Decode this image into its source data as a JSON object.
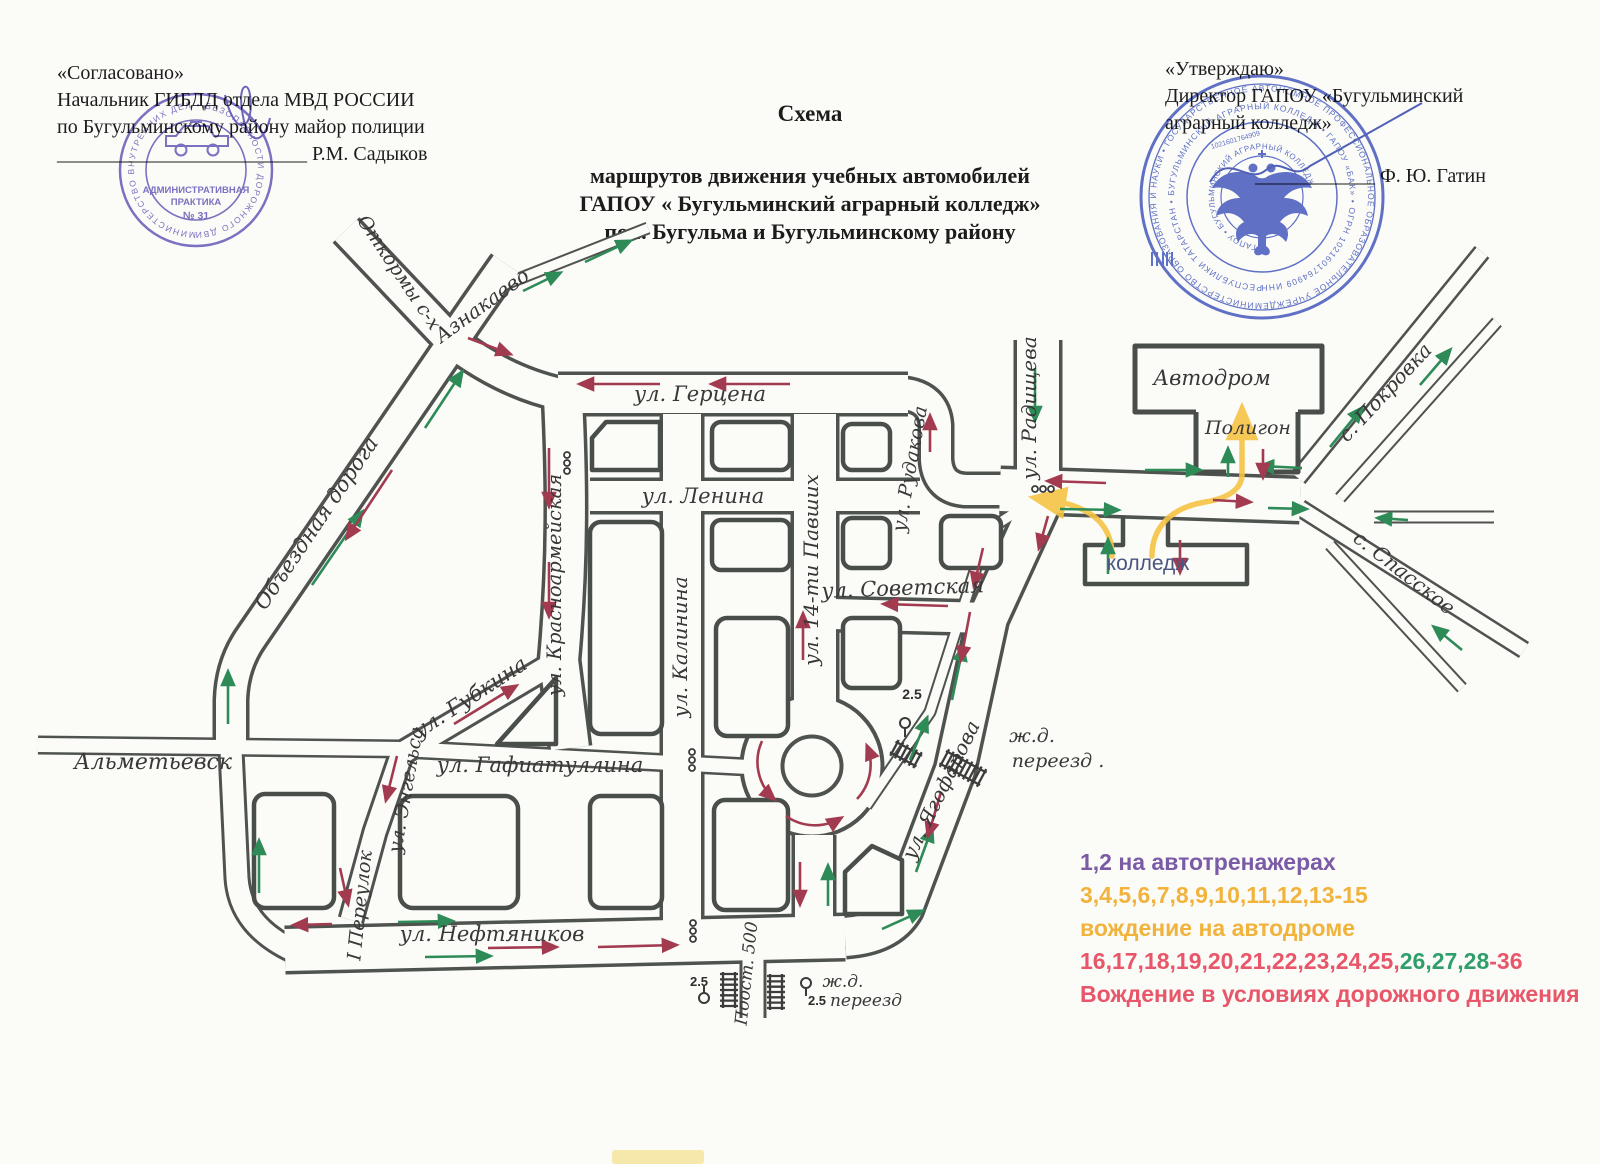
{
  "header": {
    "approval_left": {
      "quoted": "«Согласовано»",
      "line2": "Начальник ГИБДД отдела МВД РОССИИ",
      "line3": "по Бугульминскому району майор полиции",
      "line4": "_________________________ Р.М. Садыков"
    },
    "title": {
      "t1": "Схема",
      "t2": "маршрутов движения учебных автомобилей",
      "t3": "ГАПОУ  « Бугульминский аграрный колледж»",
      "t4": "по г. Бугульма и Бугульминскому району"
    },
    "approval_right": {
      "quoted": "«Утверждаю»",
      "line2": "Директор ГАПОУ   «Бугульминский",
      "line3": "аграрный колледж»",
      "line4": "____________ Ф. Ю. Гатин"
    }
  },
  "stamps": {
    "left": {
      "ring": "МИНИСТЕРСТВО ВНУТРЕННИХ ДЕЛ  •  БЕЗОПАСНОСТИ ДОРОЖНОГО ДВИЖЕНИЯ  •  ТАТАРСТАН  •",
      "line1": "АДМИНИСТРАТИВНАЯ",
      "line2": "ПРАКТИКА",
      "line3": "№ 31"
    },
    "right": {
      "ring_outer": "МИНИСТЕРСТВО ОБРАЗОВАНИЯ И НАУКИ  •  ГОСУДАРСТВЕННОЕ АВТОНОМНОЕ ПРОФЕССИОНАЛЬНОЕ ОБРАЗОВАТЕЛЬНОЕ УЧРЕЖДЕНИЕ  •  РОССИЙСКОЙ ФЕДЕРАЦИИ",
      "ring_mid": "РЕСПУБЛИКИ ТАТАРСТАН  •  БУГУЛЬМИНСКИЙ АГРАРНЫЙ КОЛЛЕДЖ  •  ГАПОУ «БАК»  •  ОГРН 1021601764909 ИНН",
      "ring_inner": "•  ГАПОУ  •  БУГУЛЬМИНСКИЙ АГРАРНЫЙ КОЛЛЕДЖ",
      "ogrn": "1021601764909"
    }
  },
  "legend": {
    "line1": "1,2   на автотренажерах",
    "line2": "3,4,5,6,7,8,9,10,11,12,13-15",
    "line3": "вождение на автодроме",
    "line4_red_a": "16,17,18,19,20,21,22,23,24,25,",
    "line4_green": "26,27,28",
    "line4_red_b": "-36",
    "line5": "Вождение в условиях дорожного движения"
  },
  "map": {
    "labels": {
      "gertsena": "ул. Герцена",
      "lenina": "ул. Ленина",
      "sovetskaya": "ул. Советская",
      "krasnoarmeyskaya": "ул. Красноармейская",
      "kalinina": "ул. Калинина",
      "pavshikh": "ул. 14-ти Павших",
      "radishcheva": "ул. Радищева",
      "rudakova": "ул. Рудакова",
      "yagofarova": "ул. Ягофарова",
      "gubkina": "ул. Губкина",
      "gafiatullina": "ул. Гафиатуллина",
      "engelsa": "ул. Энгельса",
      "pereulok": "I Переулок",
      "neftyanikov": "ул. Нефтяников",
      "obyezdnaya": "Объездная  дорога",
      "almetyevsk": "Альметьевск",
      "aznakaevo": "Азнакаево",
      "otkormy": "Откормы с-х",
      "pokrovka": "с. Покровка",
      "spasskoe": "с. Спасское",
      "avtodrom": "Автодром",
      "poligon": "Полигон",
      "kolledzh": "колледж",
      "zhd_ne": "ж.д.",
      "pereezd_ne": "переезд .",
      "zhd_b": "ж.д.",
      "pereezd_b": "переезд",
      "n25_ne": "2.5",
      "n25_bl": "2.5",
      "n25_br": "2.5",
      "post500": "Поост. 500"
    },
    "colors": {
      "road_casing": "#4f534f",
      "arrow_green": "#2e8b57",
      "arrow_red": "#a23b50",
      "route_yellow": "#f6c445",
      "stamp_purple": "#5b50b8",
      "stamp_blue": "#3d53c0"
    }
  }
}
